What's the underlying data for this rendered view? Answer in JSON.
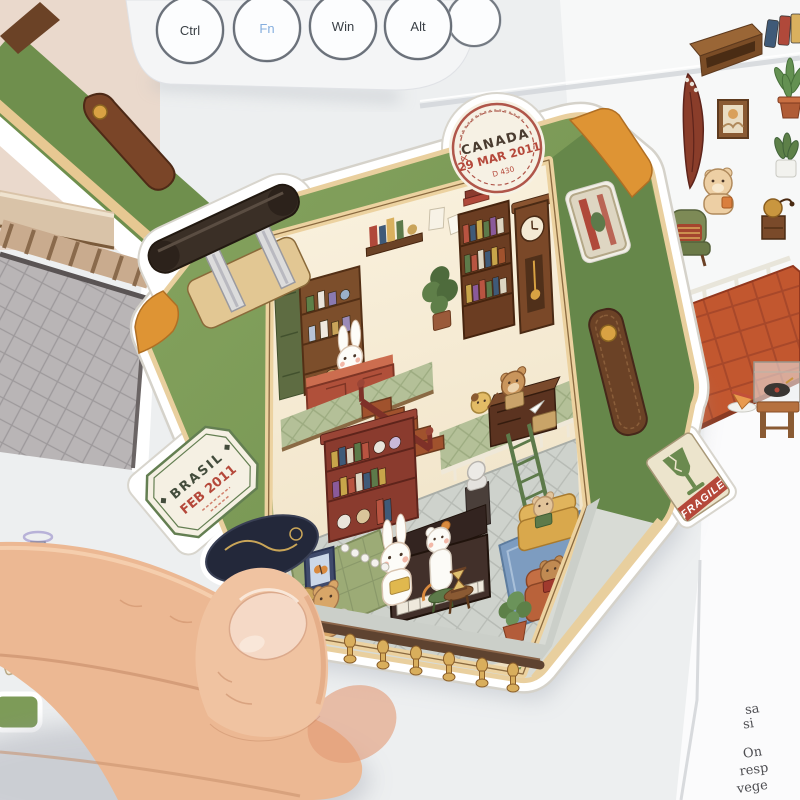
{
  "keyboard": {
    "keys": [
      {
        "label": "Ctrl",
        "color": "#3a4046"
      },
      {
        "label": "Fn",
        "color": "#85aede"
      },
      {
        "label": "Win",
        "color": "#3a4046"
      },
      {
        "label": "Alt",
        "color": "#3a4046"
      }
    ]
  },
  "suitcase": {
    "shell_color": "#7d9b58",
    "trim_color": "#ecd2a0",
    "corner_color": "#de9434",
    "canada_stamp": {
      "country": "CANADA",
      "date": "29 MAR 2011",
      "code": "D 430",
      "mark": "×"
    },
    "brasil_stamp": {
      "country": "BRASIL",
      "date": "FEB 2011"
    },
    "fragile_label": {
      "text": "FRAGILE"
    },
    "scene_objects": [
      "bar-shelf",
      "wine-bottles",
      "bunny-barista",
      "bookshelves",
      "grandfather-clock",
      "desk-bear",
      "staircase",
      "white-railing",
      "marble-bust",
      "piano",
      "cat-pianist",
      "reading-bunny",
      "yellow-sofa-bear",
      "orange-sofa-bear",
      "tea-bear",
      "hourglass-table",
      "potted-plants",
      "balustrade"
    ]
  },
  "paper": {
    "fragments": [
      "sa",
      "si",
      "On",
      "resp",
      "vege"
    ]
  }
}
